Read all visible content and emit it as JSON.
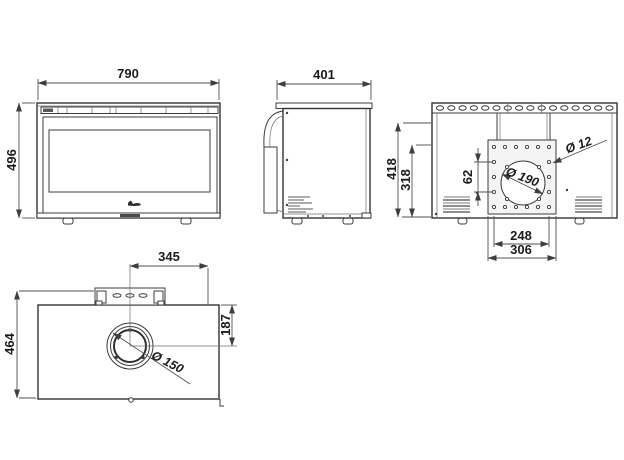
{
  "drawing": {
    "type": "technical-orthographic-drawing",
    "subject": "stove / fireplace insert dimension sheet",
    "units_shown": "mm",
    "line_color": "#3c3c3c",
    "background": "#ffffff"
  },
  "views": {
    "front": {
      "width": "790",
      "height": "496"
    },
    "side": {
      "depth": "401"
    },
    "back": {
      "overall_height": "418",
      "lower_height": "318",
      "hole_pitch": "62",
      "flue_opening_dia": "Ø 190",
      "bolt_hole_dia": "Ø 12",
      "bolt_pitch": "248",
      "plate_width": "306"
    },
    "top": {
      "flue_offset_x": "345",
      "depth": "464",
      "flue_offset_y": "187",
      "flue_dia": "Ø 150"
    }
  }
}
